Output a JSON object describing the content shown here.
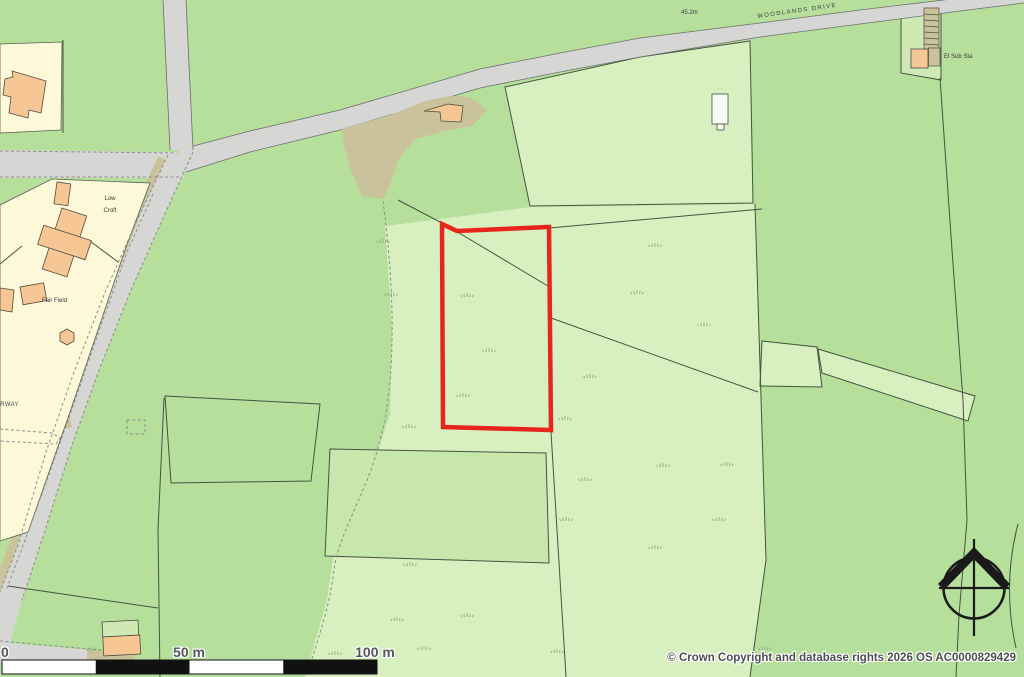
{
  "map": {
    "road_labels": {
      "main_road": "WOODLANDS DRIVE",
      "spot_height": "45.2m",
      "partial_street": "ARWAY"
    },
    "place_labels": {
      "substation": "El Sub Sta",
      "low_croft_line1": "Low",
      "low_croft_line2": "Croft",
      "fair_field": "Fair Field"
    },
    "scale_bar": {
      "zero": "0",
      "mid": "50 m",
      "end": "100 m"
    },
    "copyright": "© Crown Copyright and database rights 2026 OS AC0000829429",
    "colors": {
      "field_green": "#b5df9b",
      "rough_pasture_green": "#d8efbf",
      "inner_field_green": "#c8e7ad",
      "road_grey": "#d6d6d5",
      "plot_cream": "#fdf8d8",
      "building_orange": "#f6c795",
      "scrub_tan": "#c9c29b",
      "boundary_red": "#e8251d"
    }
  }
}
